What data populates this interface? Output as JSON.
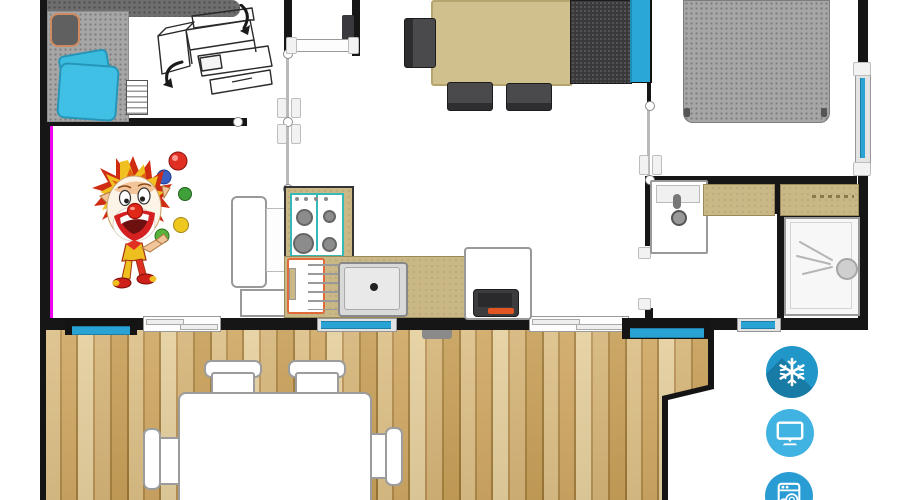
{
  "meta": {
    "kind": "mobile-home floor plan with terrace",
    "visible_text": "none"
  },
  "palette": {
    "wall": "#161616",
    "window_glass": "#29a3d4",
    "accent_magenta": "#ee00ee",
    "counter_tan": "#c9b786",
    "dining_table_tan": "#cfc08e",
    "deck_wood_mid": "#cfa763",
    "bed_gray": "#a6a6a6",
    "pillow_cyan": "#3bbde0",
    "sofa_dark": "#39393c",
    "sofa_cushion_cyan": "#2aa7d6",
    "tv_base_orange": "#e05522",
    "fridge_outline_orange": "#e06a3a"
  },
  "amenities": [
    {
      "id": "air-conditioning",
      "icon": "snowflake-icon",
      "bg": "#2196c8",
      "shadow": "#1b7fae",
      "glyph_color": "#ffffff"
    },
    {
      "id": "tv",
      "icon": "tv-icon",
      "bg": "#41b3e2",
      "glyph_color": "#ffffff"
    },
    {
      "id": "dishwasher",
      "icon": "dishwasher-icon",
      "bg": "#2a9cd4",
      "glyph_color": "#ffffff"
    }
  ],
  "illustrations": [
    {
      "id": "juggling-clown",
      "ball_colors": [
        "#e03024",
        "#3a5fc4",
        "#3fa03a",
        "#eec81f",
        "#57b33c"
      ]
    },
    {
      "id": "bunk-bed-fold-out",
      "style": "black line art with curved arrows"
    }
  ],
  "areas": [
    {
      "id": "bedroom-left",
      "furniture": [
        "wardrobe",
        "bed-with-cyan-pillows",
        "armchair",
        "step-ladder"
      ]
    },
    {
      "id": "living-kitchen",
      "furniture": [
        "dining-table",
        "chairs",
        "sofa-with-cyan-cushion",
        "stove",
        "sink",
        "fridge",
        "tv-stand"
      ]
    },
    {
      "id": "bedroom-right",
      "furniture": [
        "double-bed"
      ]
    },
    {
      "id": "bathroom",
      "furniture": [
        "washbasin",
        "counters",
        "shower"
      ]
    },
    {
      "id": "terrace",
      "furniture": [
        "outdoor-table",
        "outdoor-chairs"
      ],
      "floor": "wood-planks"
    }
  ]
}
